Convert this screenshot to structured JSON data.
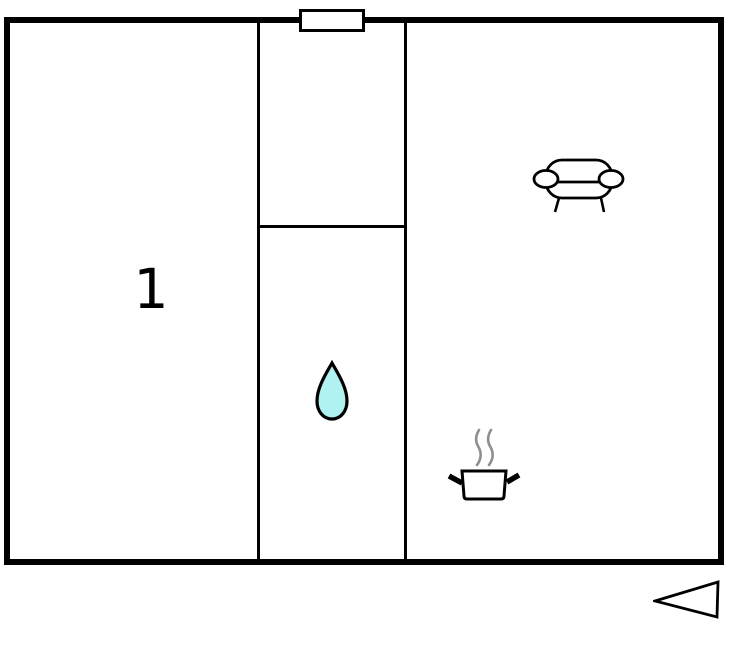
{
  "plan": {
    "background": "#ffffff",
    "wall_color": "#000000",
    "rooms": [
      {
        "label": "1"
      },
      {
        "label": "",
        "icon": "water-drop-icon"
      },
      {
        "label": "",
        "icons": [
          "sofa-icon",
          "cooking-pot-icon"
        ]
      }
    ],
    "window": {
      "icon": "window-marker"
    },
    "orientation": {
      "icon": "entrance-arrow-icon",
      "direction": "left"
    }
  },
  "colors": {
    "wall": "#000000",
    "icon_stroke": "#000000",
    "icon_fill": "#ffffff",
    "drop_fill": "#b0f1f1",
    "steam": "#8f8f8f"
  }
}
